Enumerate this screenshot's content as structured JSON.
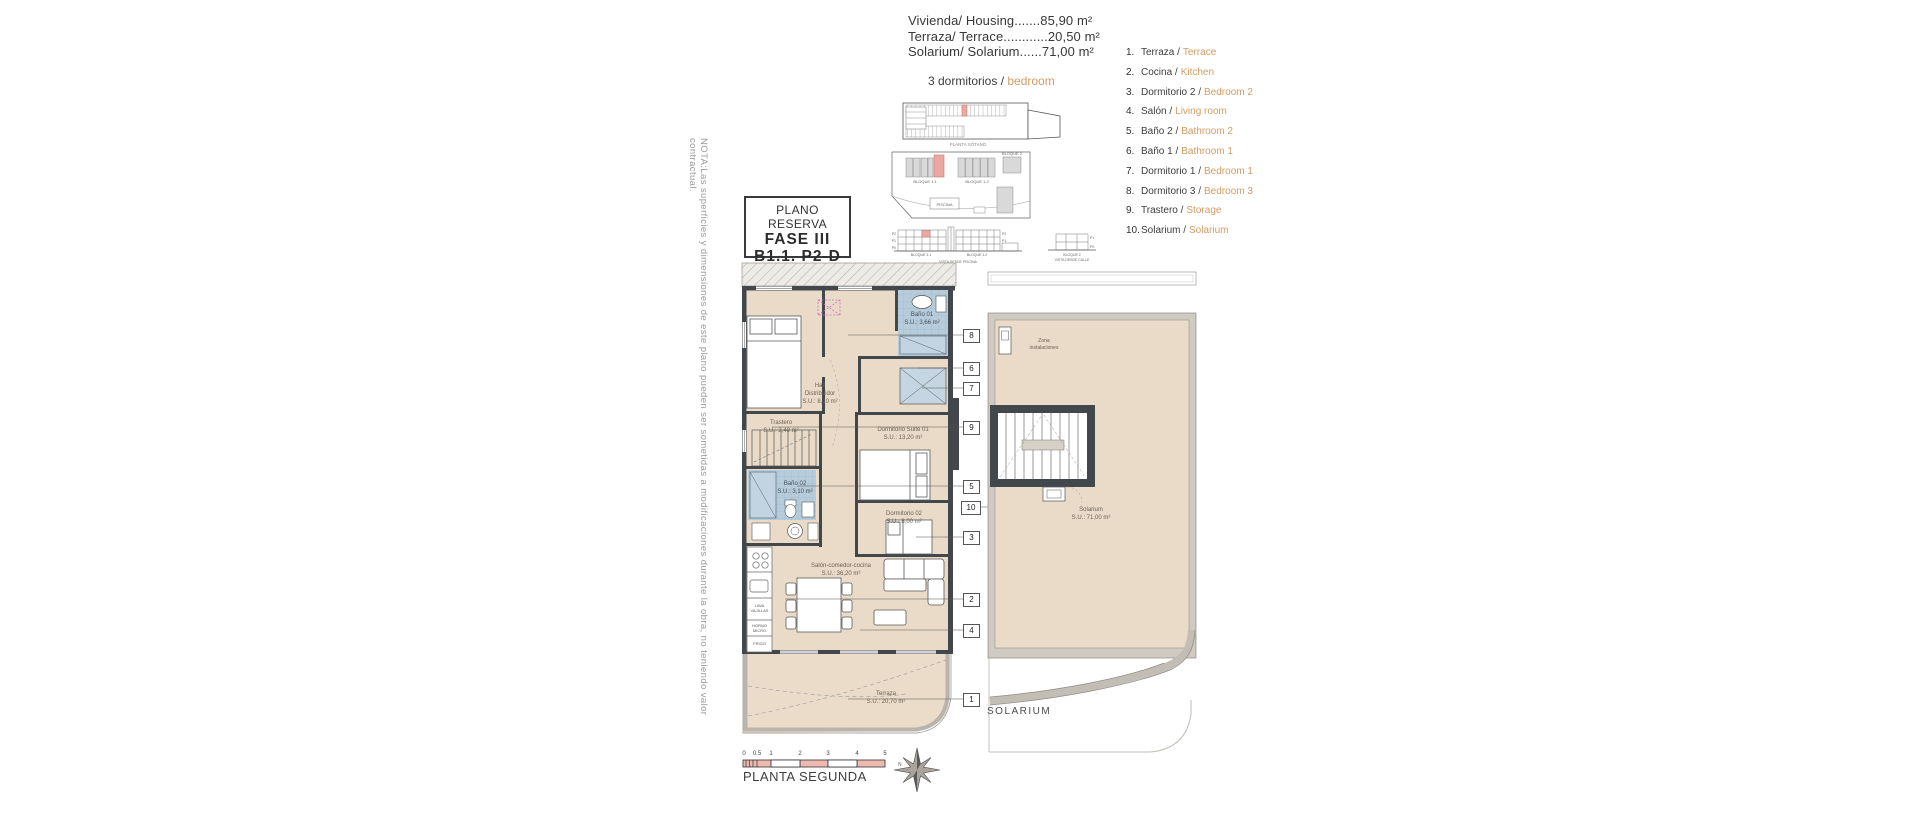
{
  "summary": {
    "line1": "Vivienda/ Housing.......85,90 m²",
    "line2": "Terraza/ Terrace............20,50 m²",
    "line3": "Solarium/ Solarium......71,00 m²",
    "bedrooms_es": "3 dormitorios / ",
    "bedrooms_en": "bedroom"
  },
  "title_block": {
    "line1": "PLANO RESERVA",
    "line2": "FASE III",
    "line3": "B1.1. P2-D"
  },
  "note_vertical": "NOTA:Las superficies y dimensiones de este plano pueden ser sometidas a modificaciones durante la obra, no teniendo valor contractual.",
  "legend": {
    "items": [
      {
        "num": "1.",
        "es": "Terraza /",
        "en": "Terrace"
      },
      {
        "num": "2.",
        "es": "Cocina /",
        "en": "Kitchen"
      },
      {
        "num": "3.",
        "es": "Dormitorio 2 /",
        "en": "Bedroom 2"
      },
      {
        "num": "4.",
        "es": "Salón /",
        "en": "Living room"
      },
      {
        "num": "5.",
        "es": "Baño 2 /",
        "en": "Bathroom 2"
      },
      {
        "num": "6.",
        "es": "Baño 1 /",
        "en": "Bathroom 1"
      },
      {
        "num": "7.",
        "es": "Dormitorio 1 /",
        "en": "Bedroom 1"
      },
      {
        "num": "8.",
        "es": "Dormitorio 3 /",
        "en": "Bedroom 3"
      },
      {
        "num": "9.",
        "es": "Trastero /",
        "en": "Storage"
      },
      {
        "num": "10.",
        "es": "Solarium /",
        "en": "Solarium"
      }
    ]
  },
  "plan": {
    "rooms": {
      "hall": "Hall\nDistribuidor\nS.U.: 8,10 m²",
      "bano1": "Baño 01\nS.U.: 3,66 m²",
      "trastero": "Trastero\nS.U.: 2,48 m²",
      "suite": "Dormitorio Suite 01\nS.U.: 13,20 m²",
      "bano2": "Baño 02\nS.U.: 3,10 m²",
      "dorm2": "Dormitorio 02\nS.U.: 8,00 m²",
      "salon": "Salón-comedor-cocina\nS.U.: 36,20 m²",
      "terraza": "Terraza\nS.U.: 20,70 m²"
    },
    "kitchen_labels": {
      "dishwasher": "LAVA\nVAJILLAS",
      "oven": "HORNO\nMICRO",
      "fridge": "FRIGO"
    },
    "callouts": [
      "8",
      "6",
      "7",
      "9",
      "5",
      "10",
      "3",
      "2",
      "4",
      "1"
    ]
  },
  "solarium_plan": {
    "zona": "Zona\ninstalaciones",
    "label": "Solarium\nS.U.: 71,00 m²",
    "caption": "SOLARIUM"
  },
  "site_diagrams": {
    "garage_caption": "PLANTA SÓTANO",
    "bloque11": "BLOQUE 1.1",
    "bloque12": "BLOQUE 1.2",
    "bloque2": "BLOQUE 2",
    "piscina": "PISCINA",
    "elevation_caption": "VISTA DESDE PISCINA",
    "bloque2_caption1": "BLOQUE 2",
    "bloque2_caption2": "VISTA DESDE CALLE",
    "floors": [
      "P2",
      "P1",
      "P0"
    ]
  },
  "footer": {
    "plan_title": "PLANTA SEGUNDA",
    "scale_ticks": [
      "0",
      "0.5",
      "1",
      "2",
      "3",
      "4",
      "5"
    ],
    "north": "N"
  },
  "colors": {
    "floor_beige": "#e9dbc8",
    "wall_dark": "#42474b",
    "bath_blue": "#b7ccda",
    "highlight_salmon": "#eba8a2",
    "accent_orange": "#d29c62",
    "band_gray": "#b9b5ad"
  }
}
